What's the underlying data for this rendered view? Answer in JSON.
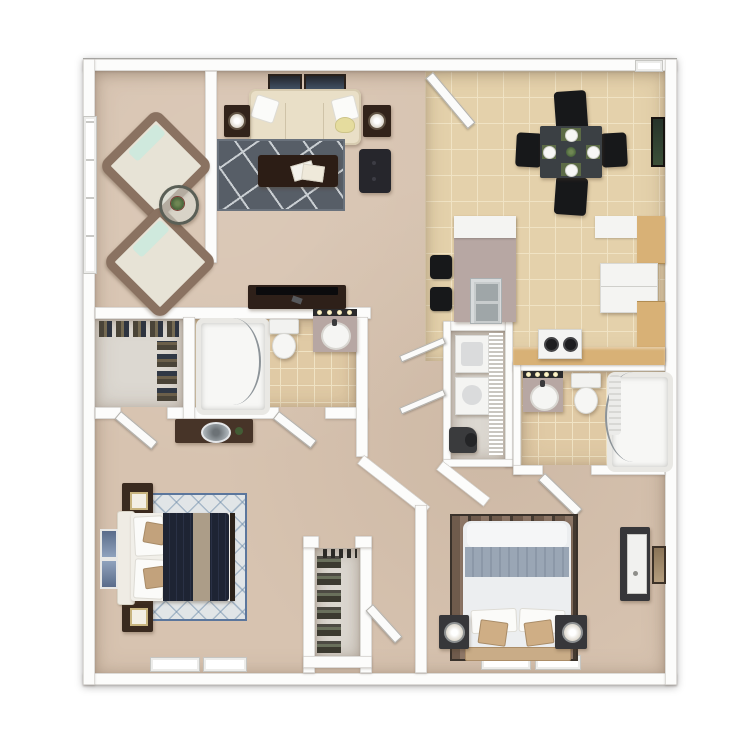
{
  "palette": {
    "wall": "#fcfcfb",
    "wall-edge": "#c9c6c1",
    "carpet": "#d7c3b0",
    "tile": "#e4d1ab",
    "tile-grout": "#f0e3c4",
    "bath-tile": "#e0caa5",
    "closet-floor": "#dcd8d1",
    "rug-dark": "#575e67",
    "rug-line": "#c9ced2",
    "rug-light": "#e1e5e7",
    "rug-diamond": "#7e98b4",
    "sofa": "#e9dfc7",
    "wood-dark": "#32231a",
    "wood-mid": "#47352a",
    "black": "#17181a",
    "table-dark": "#3b4044",
    "cabinet": "#d8b176",
    "counter": "#b7a7a3",
    "appliance": "#f4f4f2",
    "steel": "#c3c7c9",
    "mint": "#cfe9dd",
    "chair-brown": "#8a7261",
    "cream": "#e7e3d6",
    "navy": "#1e2433",
    "tan": "#c2a27c",
    "bed-white": "#eceef0",
    "bed-band": "#9aa6b5",
    "green": "#3d5a33",
    "armoire": "#37373a"
  },
  "plan": {
    "type": "3d-floor-plan-top-view",
    "rooms": [
      {
        "name": "sunroom",
        "furniture": [
          "lounge-chair",
          "lounge-chair",
          "accent-table-with-plant",
          "window"
        ]
      },
      {
        "name": "living-room",
        "furniture": [
          "sofa",
          "wall-art",
          "wall-art",
          "end-table-lamp",
          "end-table-lamp",
          "area-rug",
          "coffee-table",
          "ottoman",
          "tv-console"
        ]
      },
      {
        "name": "dining-room",
        "furniture": [
          "dining-table",
          "dining-chair",
          "dining-chair",
          "dining-chair",
          "dining-chair",
          "entry-door",
          "wall-art"
        ]
      },
      {
        "name": "kitchen",
        "furniture": [
          "peninsula-counter",
          "double-sink",
          "bar-stool",
          "bar-stool",
          "refrigerator",
          "upper-cabinets",
          "base-cabinets",
          "stove",
          "counter"
        ]
      },
      {
        "name": "laundry-closet",
        "furniture": [
          "washer",
          "dryer",
          "wire-shelving",
          "vacuum",
          "bifold-doors"
        ]
      },
      {
        "name": "bathroom-1",
        "furniture": [
          "bathtub",
          "shower-glass",
          "toilet",
          "vanity-sink",
          "vanity-lights",
          "door"
        ]
      },
      {
        "name": "walk-in-closet",
        "furniture": [
          "hanging-clothes",
          "door"
        ]
      },
      {
        "name": "hallway",
        "furniture": [
          "console-table",
          "decor-bowl",
          "plant"
        ]
      },
      {
        "name": "bathroom-2",
        "furniture": [
          "vanity-sink",
          "vanity-lights",
          "toilet",
          "bathtub-shower",
          "shower-glass",
          "door"
        ]
      },
      {
        "name": "bedroom-1",
        "furniture": [
          "bed",
          "nightstand",
          "nightstand",
          "table-lamp",
          "table-lamp",
          "diamond-rug",
          "wall-art",
          "window",
          "window",
          "door"
        ]
      },
      {
        "name": "bedroom-2",
        "furniture": [
          "bed",
          "nightstand",
          "nightstand",
          "table-lamp",
          "table-lamp",
          "striped-rug",
          "armoire",
          "wall-art",
          "window",
          "window",
          "door"
        ]
      },
      {
        "name": "shoe-closet",
        "furniture": [
          "shoe-rack",
          "hanging-clothes",
          "door"
        ]
      }
    ]
  }
}
